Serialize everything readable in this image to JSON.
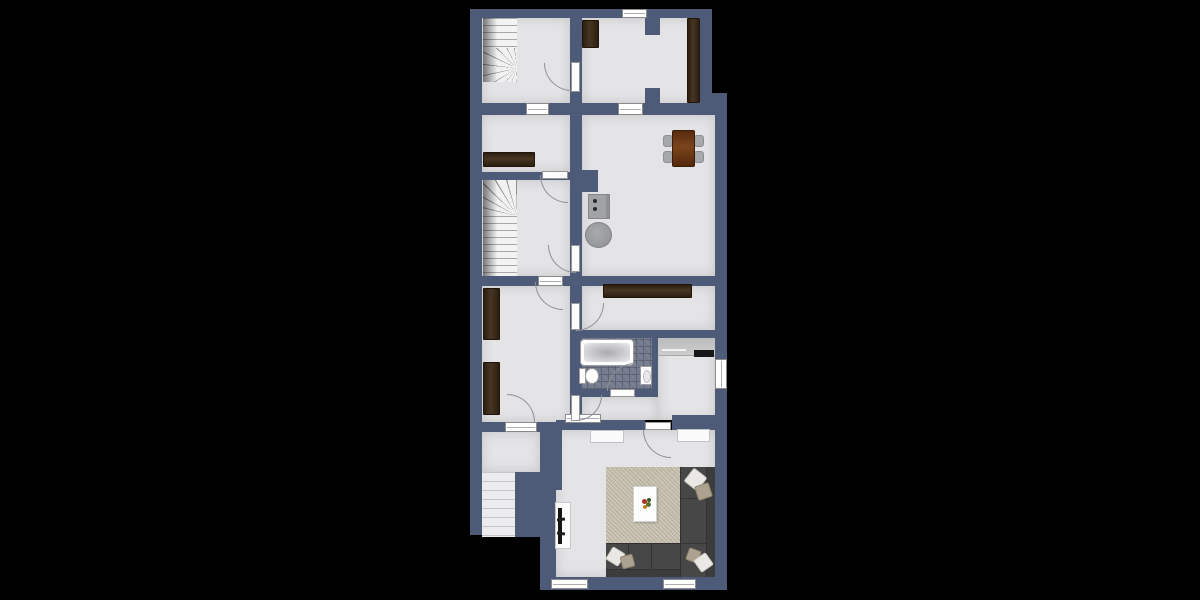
{
  "title": "apartment-floor-plan",
  "canvas": {
    "width": 1200,
    "height": 600,
    "background": "#000000"
  },
  "palette": {
    "wall": "#4d5a78",
    "floor": "#e4e4e6",
    "bathroom_tile": "#737a8d",
    "dark_wood": "#3a2b1a",
    "dining_table_wood": "#5c2f11",
    "appliance_gray": "#a2a3a5",
    "sofa_gray": "#474747",
    "rug_beige": "#c7c0ae",
    "fixture_white": "#ffffff",
    "frame_gray": "#8a8a8a",
    "counter_gray": "#c9c9cb",
    "tv_black": "#151515"
  },
  "rooms": [
    {
      "id": "hall-upper-left",
      "furniture": [
        "winder-staircase"
      ]
    },
    {
      "id": "bedroom-upper-right",
      "furniture": [
        "small-wardrobe",
        "tall-wardrobe",
        "chimney-pilasters"
      ]
    },
    {
      "id": "kitchen-dining",
      "furniture": [
        "dining-table",
        "dining-chairs-x4",
        "stove-two-burners",
        "round-side-table"
      ]
    },
    {
      "id": "sitting-room-mid-left",
      "furniture": [
        "sideboard"
      ]
    },
    {
      "id": "stairwell",
      "furniture": [
        "main-staircase-with-winder"
      ]
    },
    {
      "id": "bedroom-middle",
      "furniture": [
        "wardrobe-upper",
        "wardrobe-lower"
      ]
    },
    {
      "id": "storage-room",
      "furniture": [
        "long-sideboard"
      ]
    },
    {
      "id": "bathroom",
      "furniture": [
        "bathtub",
        "toilet",
        "wash-basin"
      ]
    },
    {
      "id": "study-nook",
      "furniture": [
        "counter-desk",
        "dark-appliance"
      ]
    },
    {
      "id": "corridor",
      "furniture": []
    },
    {
      "id": "entry-landing",
      "furniture": [
        "exterior-stairs"
      ]
    },
    {
      "id": "living-room",
      "furniture": [
        "area-rug",
        "sectional-sofa",
        "throw-pillows-x6",
        "coffee-table",
        "flower-decor",
        "tv-stand",
        "tv",
        "sideboard-left",
        "sideboard-right"
      ]
    }
  ],
  "openings": {
    "doors": 9,
    "windows": [
      "top-exterior",
      "hall-interior",
      "kitchen-interior",
      "bedroom-middle-top-opening",
      "landing-opening",
      "corridor-opening",
      "study-exterior",
      "living-bottom-left",
      "living-bottom-right"
    ]
  }
}
